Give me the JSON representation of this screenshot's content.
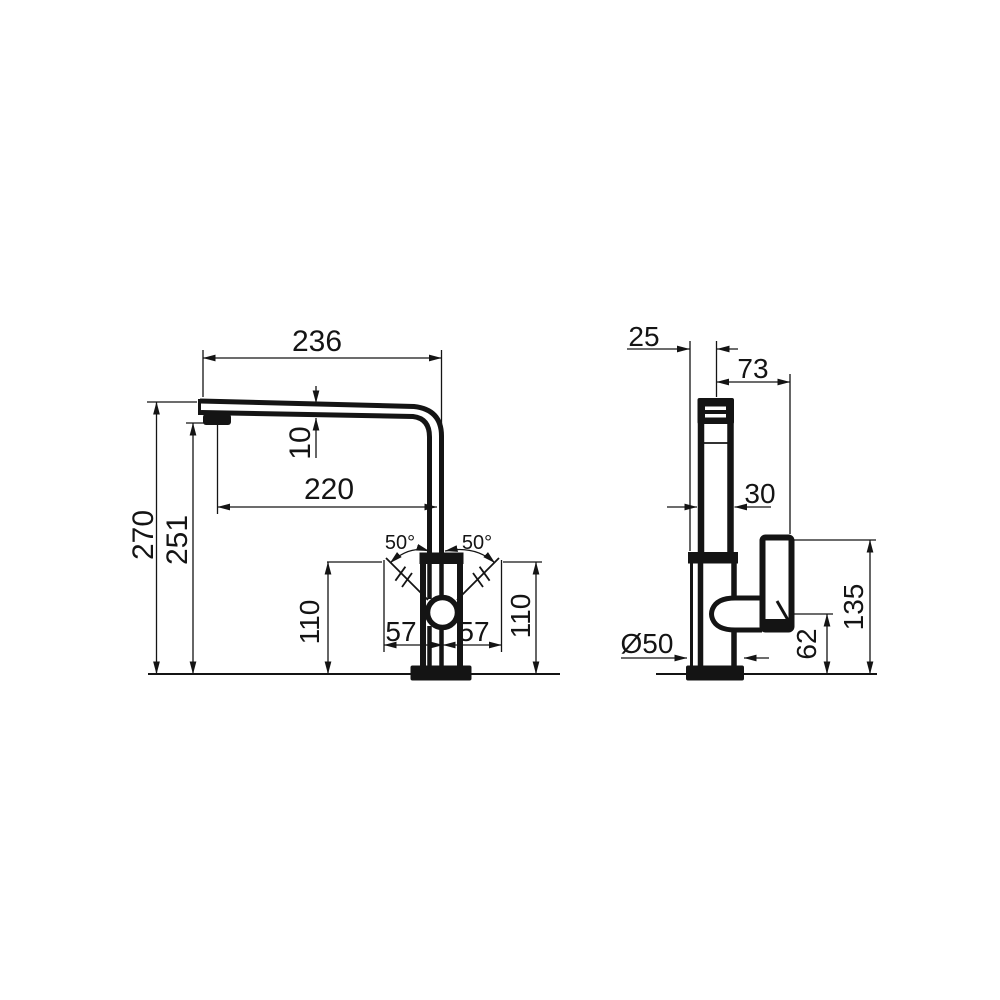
{
  "colors": {
    "ink": "#141414",
    "paper": "#ffffff"
  },
  "drawing": {
    "kind": "faucet-dimension-drawing",
    "front": {
      "labels": {
        "reach_overall": "236",
        "reach_to_body": "220",
        "spout_thickness": "10",
        "overall_height": "270",
        "spout_height": "251",
        "swing_left": "50°",
        "swing_right": "50°",
        "lever_left": "57",
        "lever_right": "57",
        "height_left": "110",
        "height_right": "110"
      }
    },
    "side": {
      "labels": {
        "spout_offset": "25",
        "handle_reach": "73",
        "body_width": "30",
        "base_diameter": "Ø50",
        "lever_height": "62",
        "handle_height": "135"
      }
    }
  }
}
